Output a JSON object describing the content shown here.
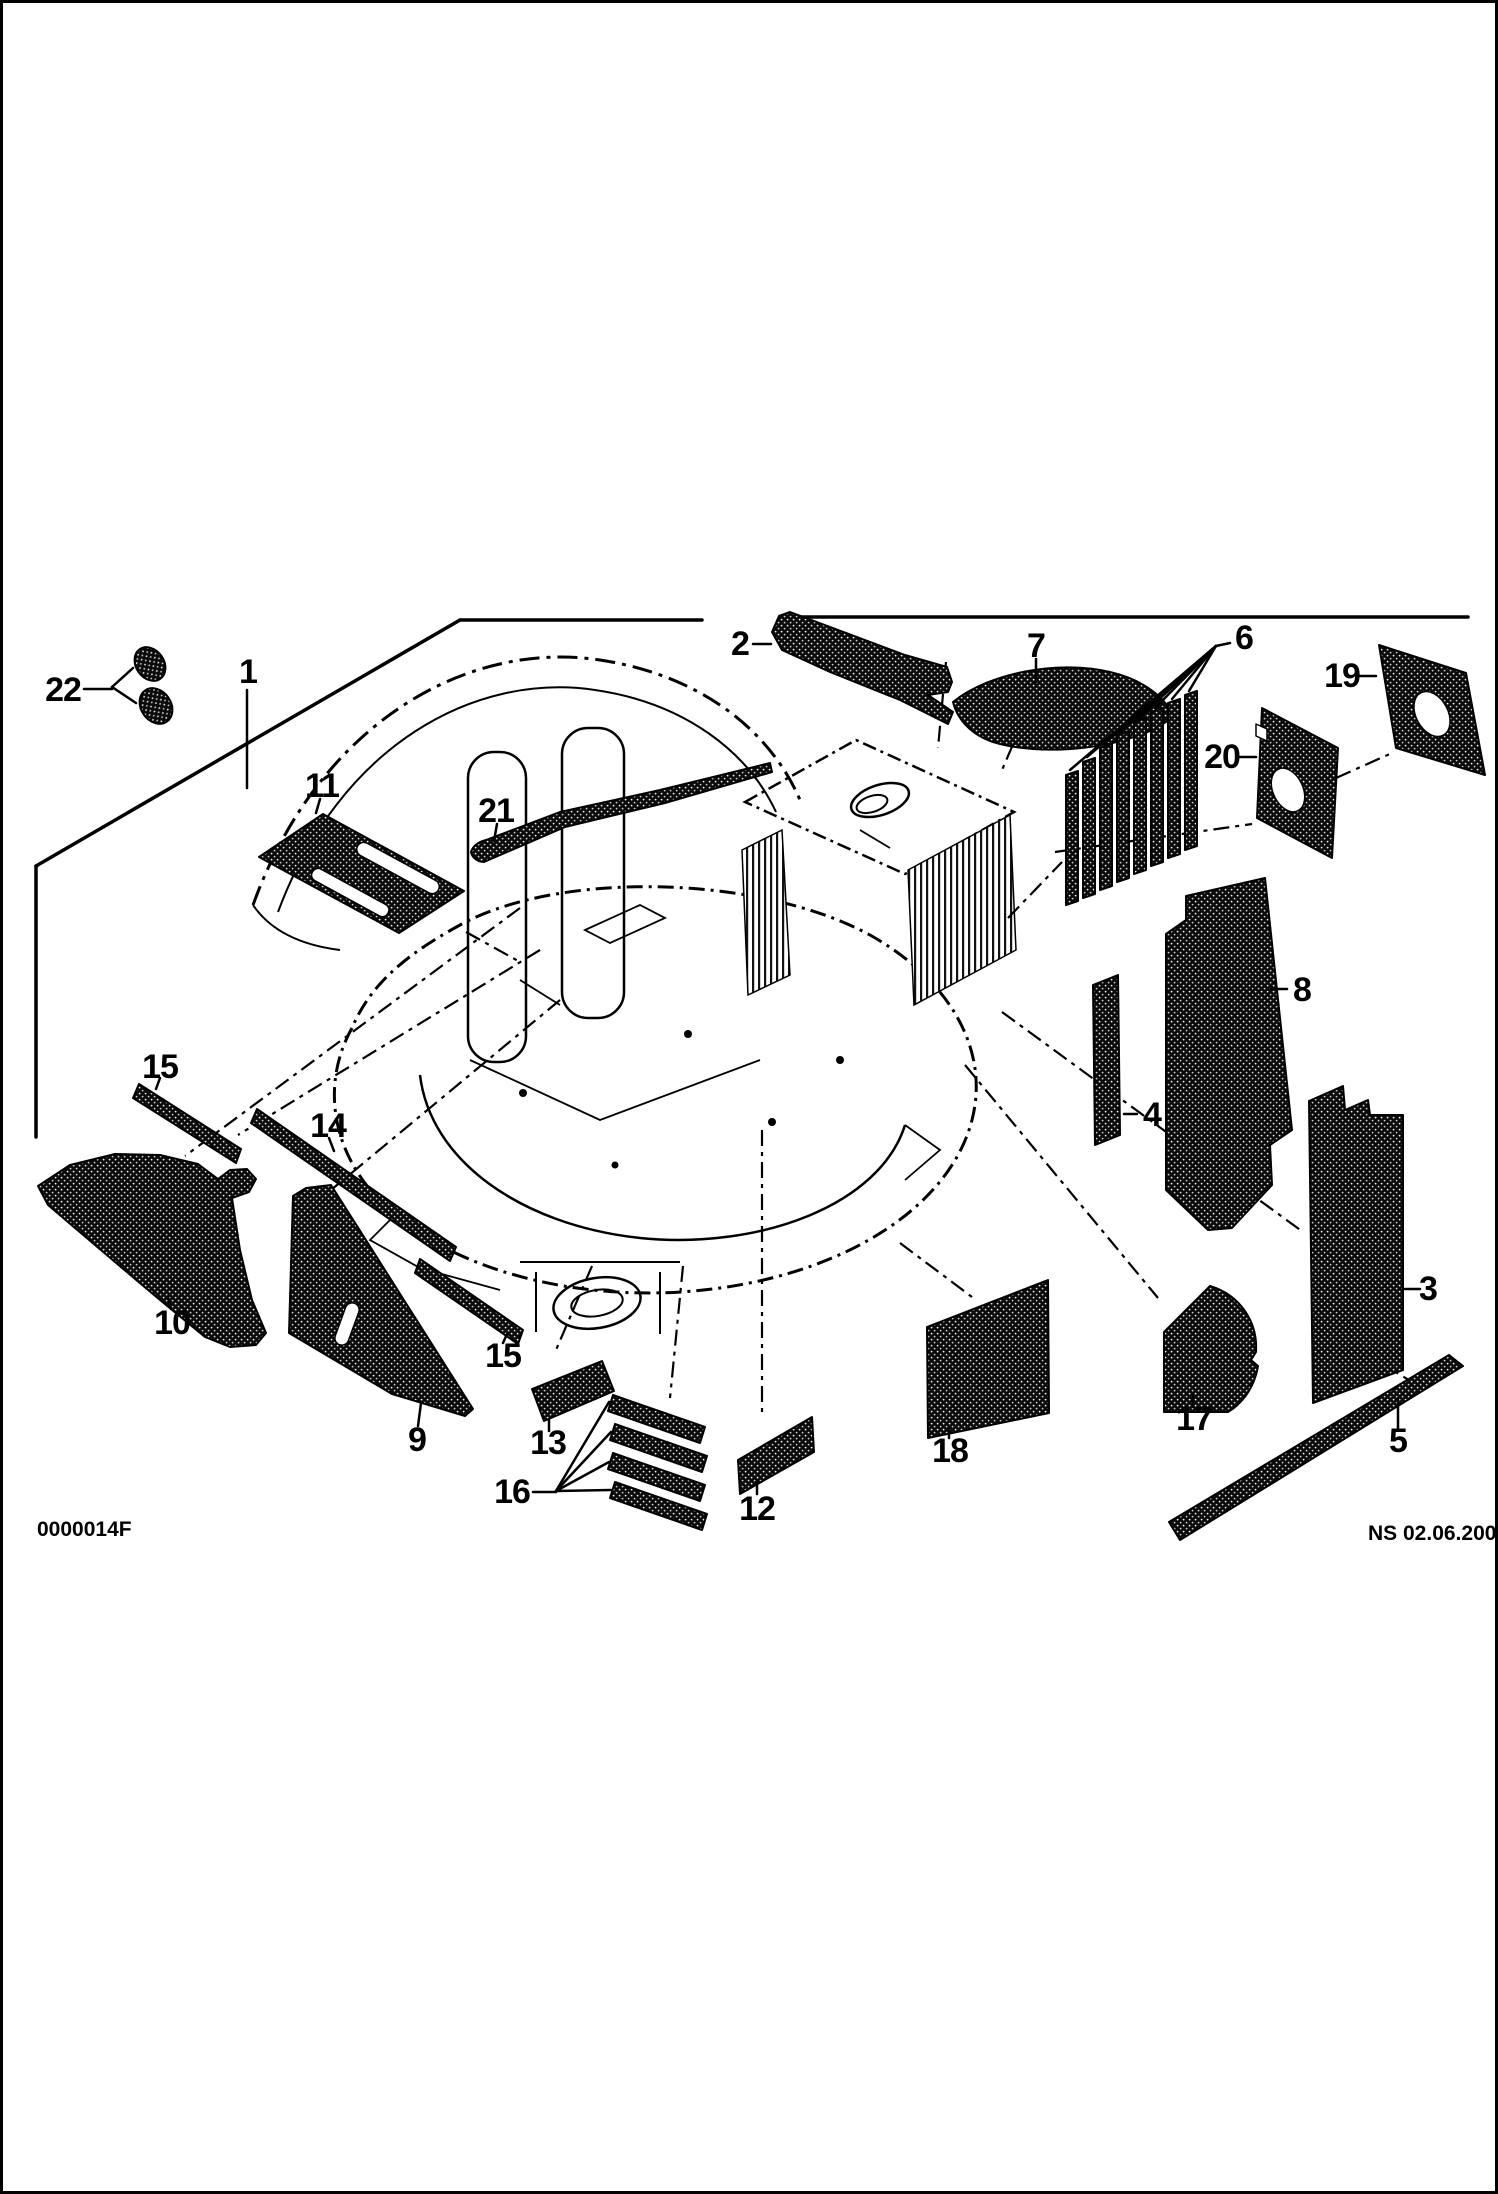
{
  "colors": {
    "ink": "#000000",
    "paper": "#ffffff"
  },
  "footer": {
    "drawing_number": "0000014F",
    "revision_note": "NS 02.06.2001"
  },
  "callouts": [
    {
      "id": "1",
      "label": "1"
    },
    {
      "id": "2",
      "label": "2"
    },
    {
      "id": "3",
      "label": "3"
    },
    {
      "id": "4",
      "label": "4"
    },
    {
      "id": "5",
      "label": "5"
    },
    {
      "id": "6",
      "label": "6"
    },
    {
      "id": "7",
      "label": "7"
    },
    {
      "id": "8",
      "label": "8"
    },
    {
      "id": "9",
      "label": "9"
    },
    {
      "id": "10",
      "label": "10"
    },
    {
      "id": "11",
      "label": "11"
    },
    {
      "id": "12",
      "label": "12"
    },
    {
      "id": "13",
      "label": "13"
    },
    {
      "id": "14",
      "label": "14"
    },
    {
      "id": "15-upper",
      "label": "15"
    },
    {
      "id": "15-lower",
      "label": "15"
    },
    {
      "id": "16",
      "label": "16"
    },
    {
      "id": "17",
      "label": "17"
    },
    {
      "id": "18",
      "label": "18"
    },
    {
      "id": "19",
      "label": "19"
    },
    {
      "id": "20",
      "label": "20"
    },
    {
      "id": "21",
      "label": "21"
    },
    {
      "id": "22",
      "label": "22"
    }
  ]
}
